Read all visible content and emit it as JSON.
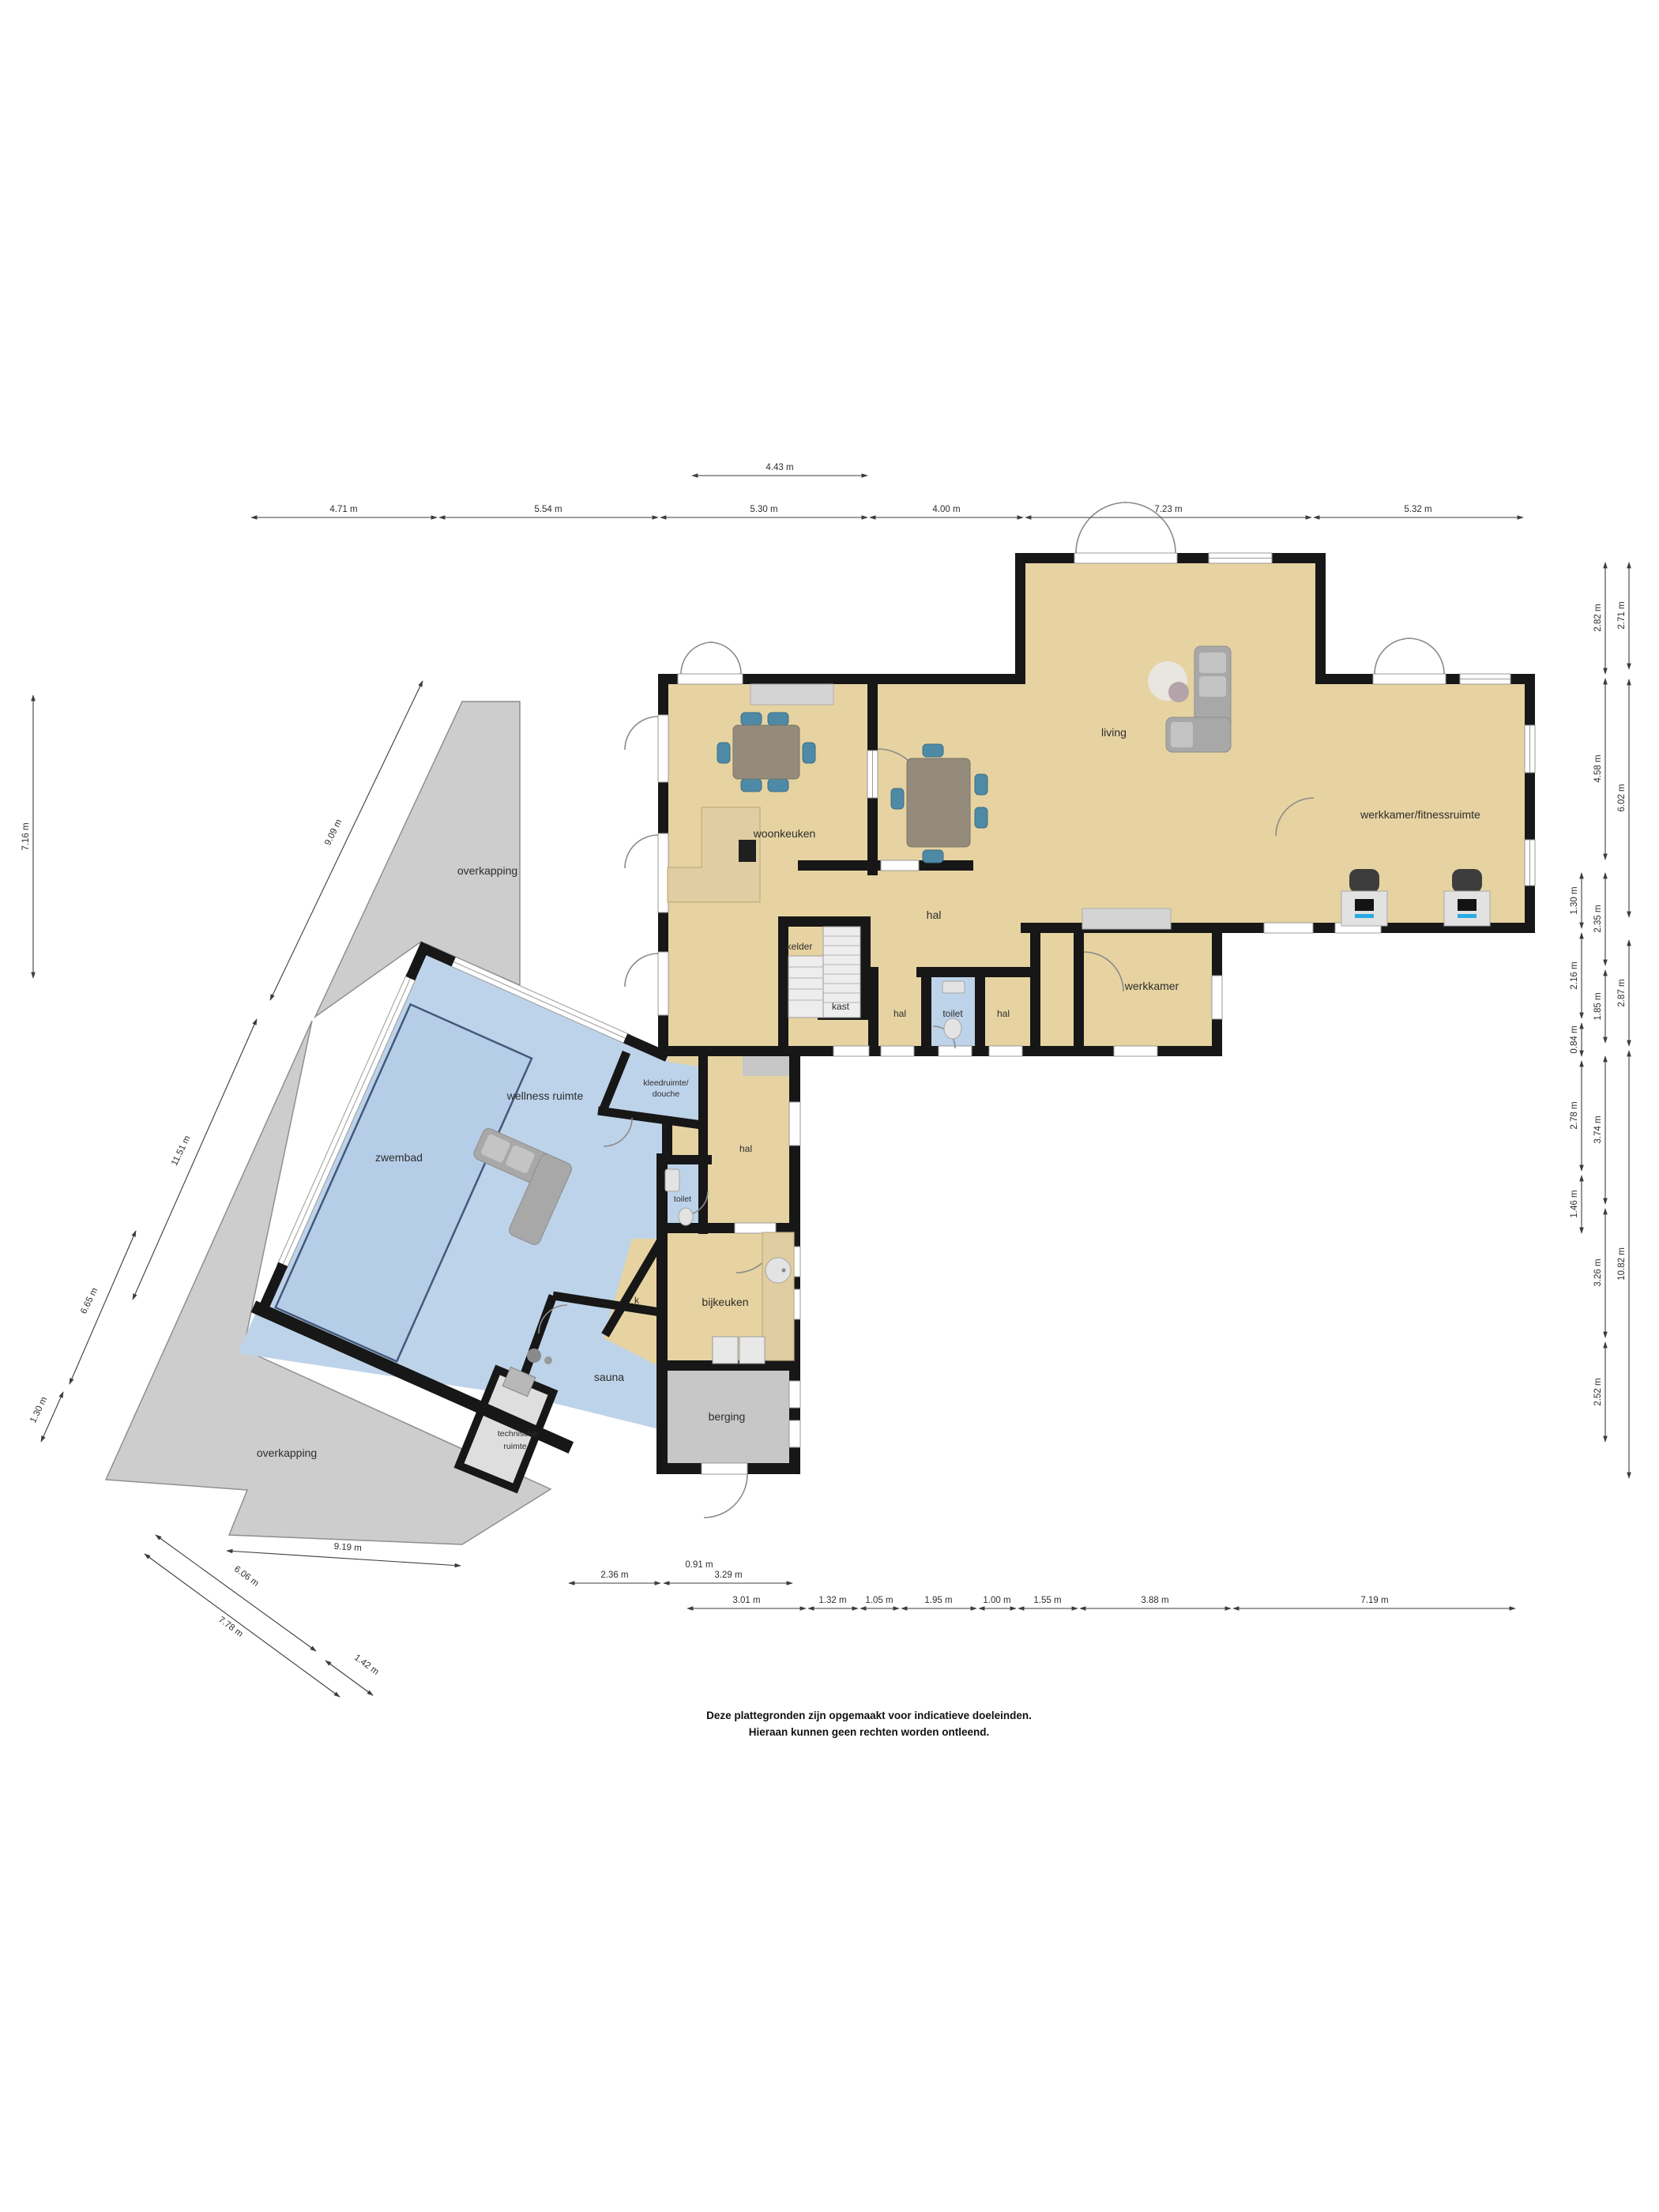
{
  "plan": {
    "type": "floorplan",
    "language": "nl",
    "rooms": {
      "woonkeuken": "woonkeuken",
      "living": "living",
      "werkkamer_fitness": "werkkamer/fitnessruimte",
      "hal": "hal",
      "kelder": "kelder",
      "kast": "kast",
      "toilet": "toilet",
      "werkkamer": "werkkamer",
      "overkapping": "overkapping",
      "zwembad": "zwembad",
      "wellness": "wellness ruimte",
      "kleedruimte_line1": "kleedruimte/",
      "kleedruimte_line2": "douche",
      "k": "k",
      "bijkeuken": "bijkeuken",
      "sauna": "sauna",
      "technische_line1": "technische",
      "technische_line2": "ruimte",
      "berging": "berging"
    },
    "dims": {
      "top": [
        "4.71 m",
        "5.54 m",
        "4.43 m",
        "5.30 m",
        "4.00 m",
        "7.23 m",
        "5.32 m"
      ],
      "left": [
        "7.16 m",
        "9.09 m",
        "11.51 m",
        "6.65 m",
        "1.30 m"
      ],
      "bottom_diagonal": [
        "9.19 m",
        "6.06 m",
        "7.78 m",
        "1.42 m"
      ],
      "bottom_row1": [
        "2.36 m",
        "0.91 m",
        "3.29 m"
      ],
      "bottom_row2": [
        "3.01 m",
        "1.32 m",
        "1.05 m",
        "1.95 m",
        "1.00 m",
        "1.55 m",
        "3.88 m",
        "7.19 m"
      ],
      "right_col1": [
        "1.30 m",
        "2.16 m",
        "0.84 m",
        "2.78 m",
        "1.46 m"
      ],
      "right_col2": [
        "2.82 m",
        "4.58 m",
        "2.35 m",
        "1.85 m",
        "3.74 m",
        "3.26 m",
        "2.52 m"
      ],
      "right_col3": [
        "2.71 m",
        "6.02 m",
        "2.87 m",
        "10.82 m"
      ]
    },
    "disclaimer": [
      "Deze plattegronden zijn opgemaakt voor indicatieve doeleinden.",
      "Hieraan kunnen geen rechten worden ontleend."
    ],
    "colors": {
      "floor_tan": "#e6d3a1",
      "floor_blue": "#bdd3ea",
      "pool_blue": "#b6cde8",
      "pool_outline": "#44597a",
      "wall_black": "#171717",
      "overkapping_gray": "#cdcdcd",
      "storage_gray": "#c7c7c7",
      "chair_teal": "#4e8aa6",
      "accent_blue": "#29abe2",
      "dim_text": "#2e2e2e"
    }
  }
}
